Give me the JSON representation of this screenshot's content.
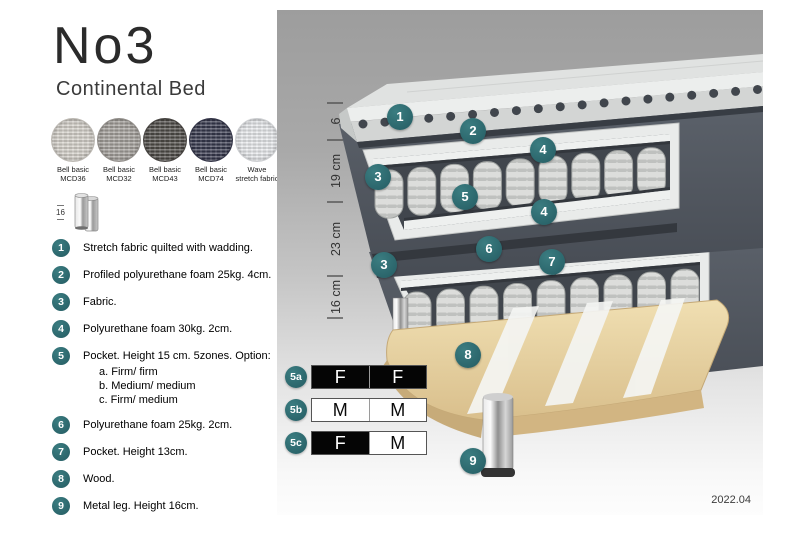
{
  "header": {
    "title": "No3",
    "subtitle": "Continental Bed"
  },
  "swatches": [
    {
      "line1": "Bell basic",
      "line2": "MCD36",
      "color": "#d6d2cb"
    },
    {
      "line1": "Bell basic",
      "line2": "MCD32",
      "color": "#a5a19c"
    },
    {
      "line1": "Bell basic",
      "line2": "MCD43",
      "color": "#504d49"
    },
    {
      "line1": "Bell basic",
      "line2": "MCD74",
      "color": "#383a4f"
    },
    {
      "line1": "Wave",
      "line2": "stretch fabric",
      "color": "#e9ebee"
    }
  ],
  "leg_figure": {
    "height": "16"
  },
  "legend": {
    "items": [
      {
        "num": "1",
        "text": "Stretch fabric quilted with wadding."
      },
      {
        "num": "2",
        "text": "Profiled polyurethane foam 25kg. 4cm."
      },
      {
        "num": "3",
        "text": "Fabric."
      },
      {
        "num": "4",
        "text": "Polyurethane foam 30kg. 2cm."
      },
      {
        "num": "5",
        "text": "Pocket. Height 15 cm. 5zones. Option:",
        "options": [
          "a. Firm/ firm",
          "b. Medium/ medium",
          "c. Firm/ medium"
        ]
      },
      {
        "num": "6",
        "text": "Polyurethane foam 25kg. 2cm."
      },
      {
        "num": "7",
        "text": "Pocket. Height 13cm."
      },
      {
        "num": "8",
        "text": "Wood."
      },
      {
        "num": "9",
        "text": "Metal leg. Height 16cm."
      }
    ]
  },
  "diagram": {
    "dimensions": [
      {
        "label": "6"
      },
      {
        "label": "19 cm"
      },
      {
        "label": "23 cm"
      },
      {
        "label": "16 cm"
      }
    ],
    "badges": [
      {
        "label": "1"
      },
      {
        "label": "2"
      },
      {
        "label": "4"
      },
      {
        "label": "3"
      },
      {
        "label": "5"
      },
      {
        "label": "4"
      },
      {
        "label": "6"
      },
      {
        "label": "7"
      },
      {
        "label": "3"
      },
      {
        "label": "8"
      },
      {
        "label": "9"
      }
    ]
  },
  "firmness": {
    "rows": [
      {
        "id": "5a",
        "cells": [
          "F",
          "F"
        ]
      },
      {
        "id": "5b",
        "cells": [
          "M",
          "M"
        ]
      },
      {
        "id": "5c",
        "cells": [
          "F",
          "M"
        ]
      }
    ]
  },
  "footer": {
    "version": "2022.04"
  },
  "colors": {
    "accent_teal": "#2e6b70",
    "fabric_dark": "#565c65",
    "wood": "#e6d2a2",
    "spring": "#d9dad8"
  }
}
